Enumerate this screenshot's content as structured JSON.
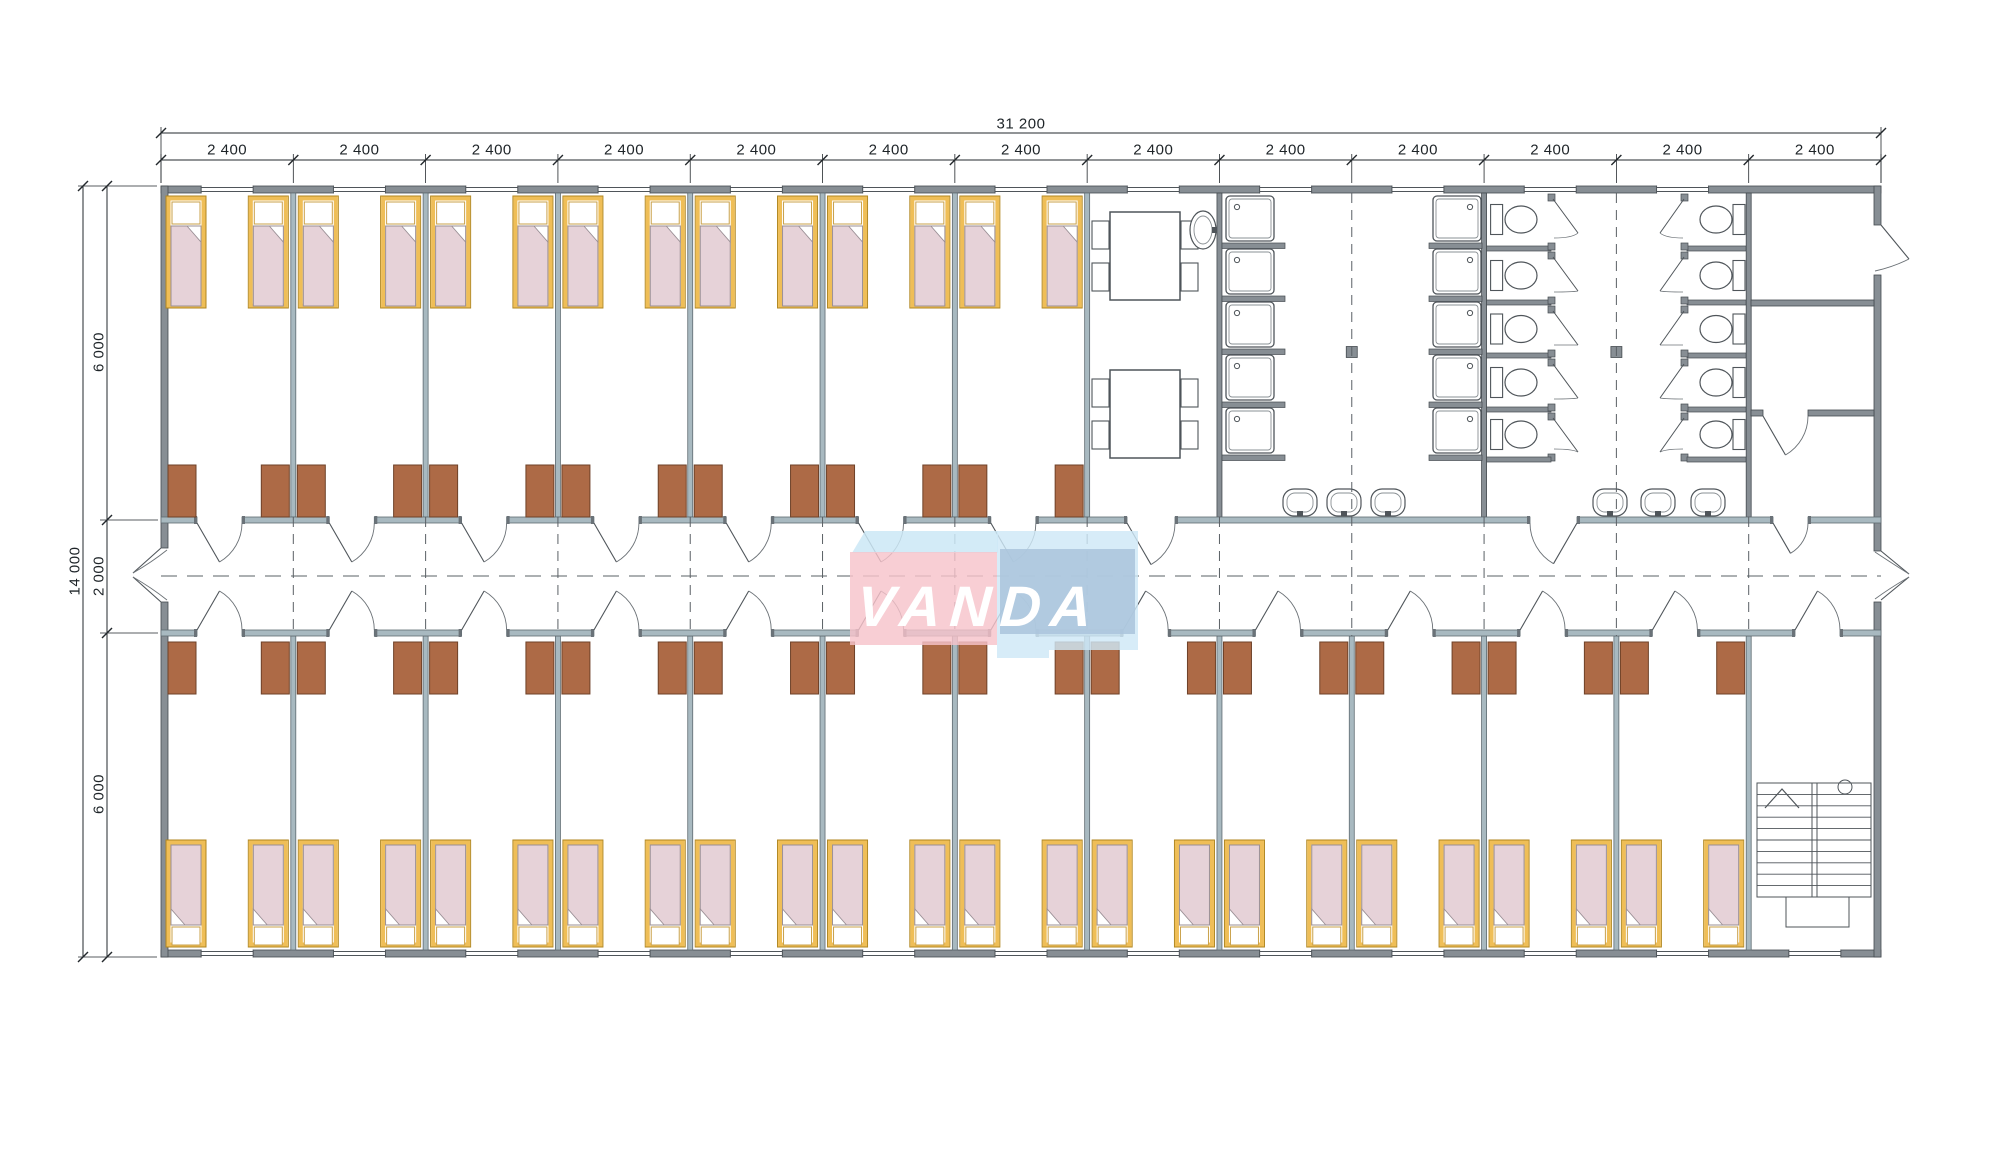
{
  "dimensions": {
    "top_total": "31 200",
    "top_segments": [
      "2 400",
      "2 400",
      "2 400",
      "2 400",
      "2 400",
      "2 400",
      "2 400",
      "2 400",
      "2 400",
      "2 400",
      "2 400",
      "2 400",
      "2 400"
    ],
    "left_total": "14 000",
    "left_segments": [
      "6 000",
      "2 000",
      "6 000"
    ]
  },
  "logo": {
    "text": "VANDA"
  },
  "colors": {
    "wall": "#878E94",
    "wall_stroke": "#454B50",
    "partition": "#A8B9C0",
    "partition_stroke": "#5F6B71",
    "cap": "#6A7278",
    "wardrobe": "#AD6A46",
    "wardrobe_stroke": "#6E4128",
    "bed_frame": "#EFBE57",
    "bed_frame_stroke": "#B0861F",
    "pillow_stroke": "#C9A04A",
    "blanket": "#E6D2D8",
    "blanket_stroke": "#9A8F95",
    "fixture_stroke": "#4F555A",
    "fixture_inner": "#8A9094",
    "swing": "#6B7176",
    "dash": "#5A6065",
    "dim": "#23282C",
    "logo_pink": "rgba(246,195,203,0.82)",
    "logo_flap_blue": "rgba(203,231,246,0.85)",
    "logo_blue": "rgba(206,232,246,0.82)",
    "logo_blue_inner": "rgba(170,196,220,0.85)",
    "logo_text": "#FFFFFF"
  }
}
